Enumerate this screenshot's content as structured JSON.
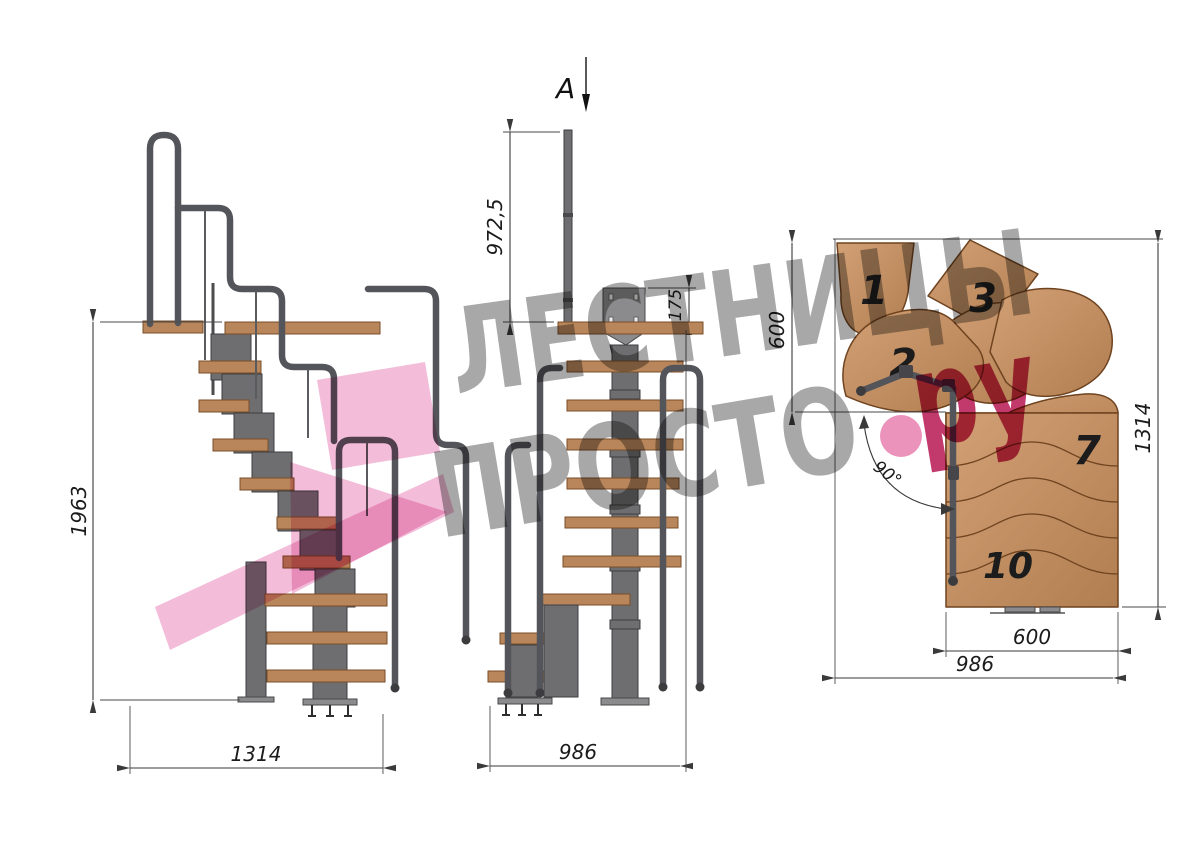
{
  "views": {
    "side": {
      "title": "side-elevation",
      "height_label": "1963",
      "width_label": "1314"
    },
    "front": {
      "title": "front-elevation",
      "section_label": "A",
      "post_height_label": "972,5",
      "plate_height_label": "175",
      "width_label": "986"
    },
    "plan": {
      "title": "top-plan",
      "fan_depth_label": "600",
      "total_depth_label": "1314",
      "flight_width_label": "600",
      "total_width_label": "986",
      "turn_angle_label": "90°",
      "tread_numbers": [
        "1",
        "2",
        "3",
        "7",
        "10"
      ]
    }
  },
  "watermark": {
    "line1": "ЛЕСТНИЦЫ",
    "line2": "ПРОСТО",
    "suffix": "ру",
    "text_color": "#a8a8a8",
    "accent_color": "#c23a6b",
    "dot_color": "#ec93bb",
    "shape_color": "#f3bcd9"
  },
  "colors": {
    "background": "#ffffff",
    "wood": "#b8865a",
    "wood_light": "#d2a075",
    "wood_outline": "#6f431f",
    "metal": "#6e6e70",
    "metal_dark": "#3e3e40",
    "dimension_lines": "#3a3a3a"
  }
}
